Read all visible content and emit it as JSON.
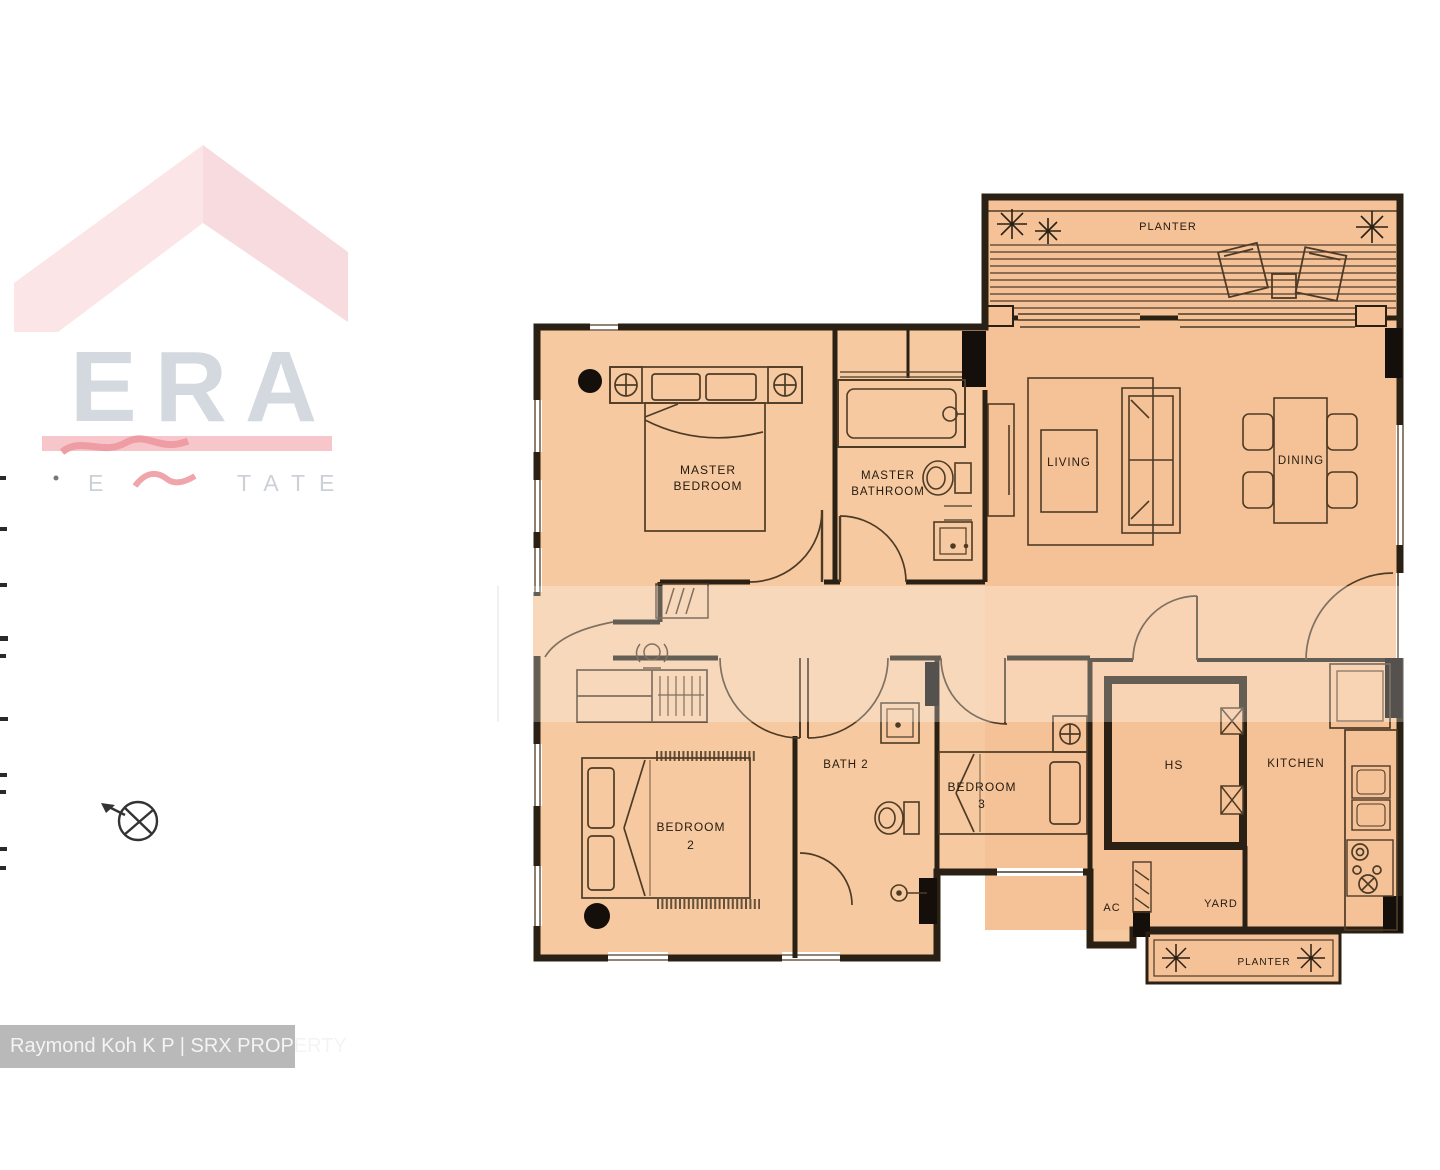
{
  "watermark": {
    "brand": "ERA",
    "partial_left": "E",
    "partial_right": "TATE"
  },
  "caption": {
    "text": "Raymond Koh K P | SRX PROPERTY"
  },
  "rooms": {
    "planter_top": {
      "label": "PLANTER"
    },
    "living": {
      "label": "LIVING"
    },
    "dining": {
      "label": "DINING"
    },
    "master_bedroom": {
      "line1": "MASTER",
      "line2": "BEDROOM"
    },
    "master_bathroom": {
      "line1": "MASTER",
      "line2": "BATHROOM"
    },
    "bedroom2": {
      "line1": "BEDROOM",
      "line2": "2"
    },
    "bath2": {
      "label": "BATH 2"
    },
    "bedroom3": {
      "line1": "BEDROOM",
      "line2": "3"
    },
    "hs": {
      "label": "HS"
    },
    "kitchen": {
      "label": "KITCHEN"
    },
    "ac": {
      "label": "AC"
    },
    "yard": {
      "label": "YARD"
    },
    "planter_bottom": {
      "label": "PLANTER"
    }
  },
  "icons": {
    "compass": "compass-north-icon",
    "plants": "plant-icon"
  },
  "colors": {
    "floor_left": "#f6c9a0",
    "floor_right": "#f5c298",
    "wall": "#2a2014",
    "furniture_line": "#4e3b26",
    "label_text": "#241b10",
    "watermark_roof_left": "#fbe5e7",
    "watermark_roof_right": "#f8dbde",
    "watermark_bar": "#f7c6ca",
    "watermark_scribble": "#ef9da4",
    "watermark_letters": "#d4d9e0",
    "caption_bg": "#b9b9b9",
    "caption_text": "#f4f4f4"
  }
}
